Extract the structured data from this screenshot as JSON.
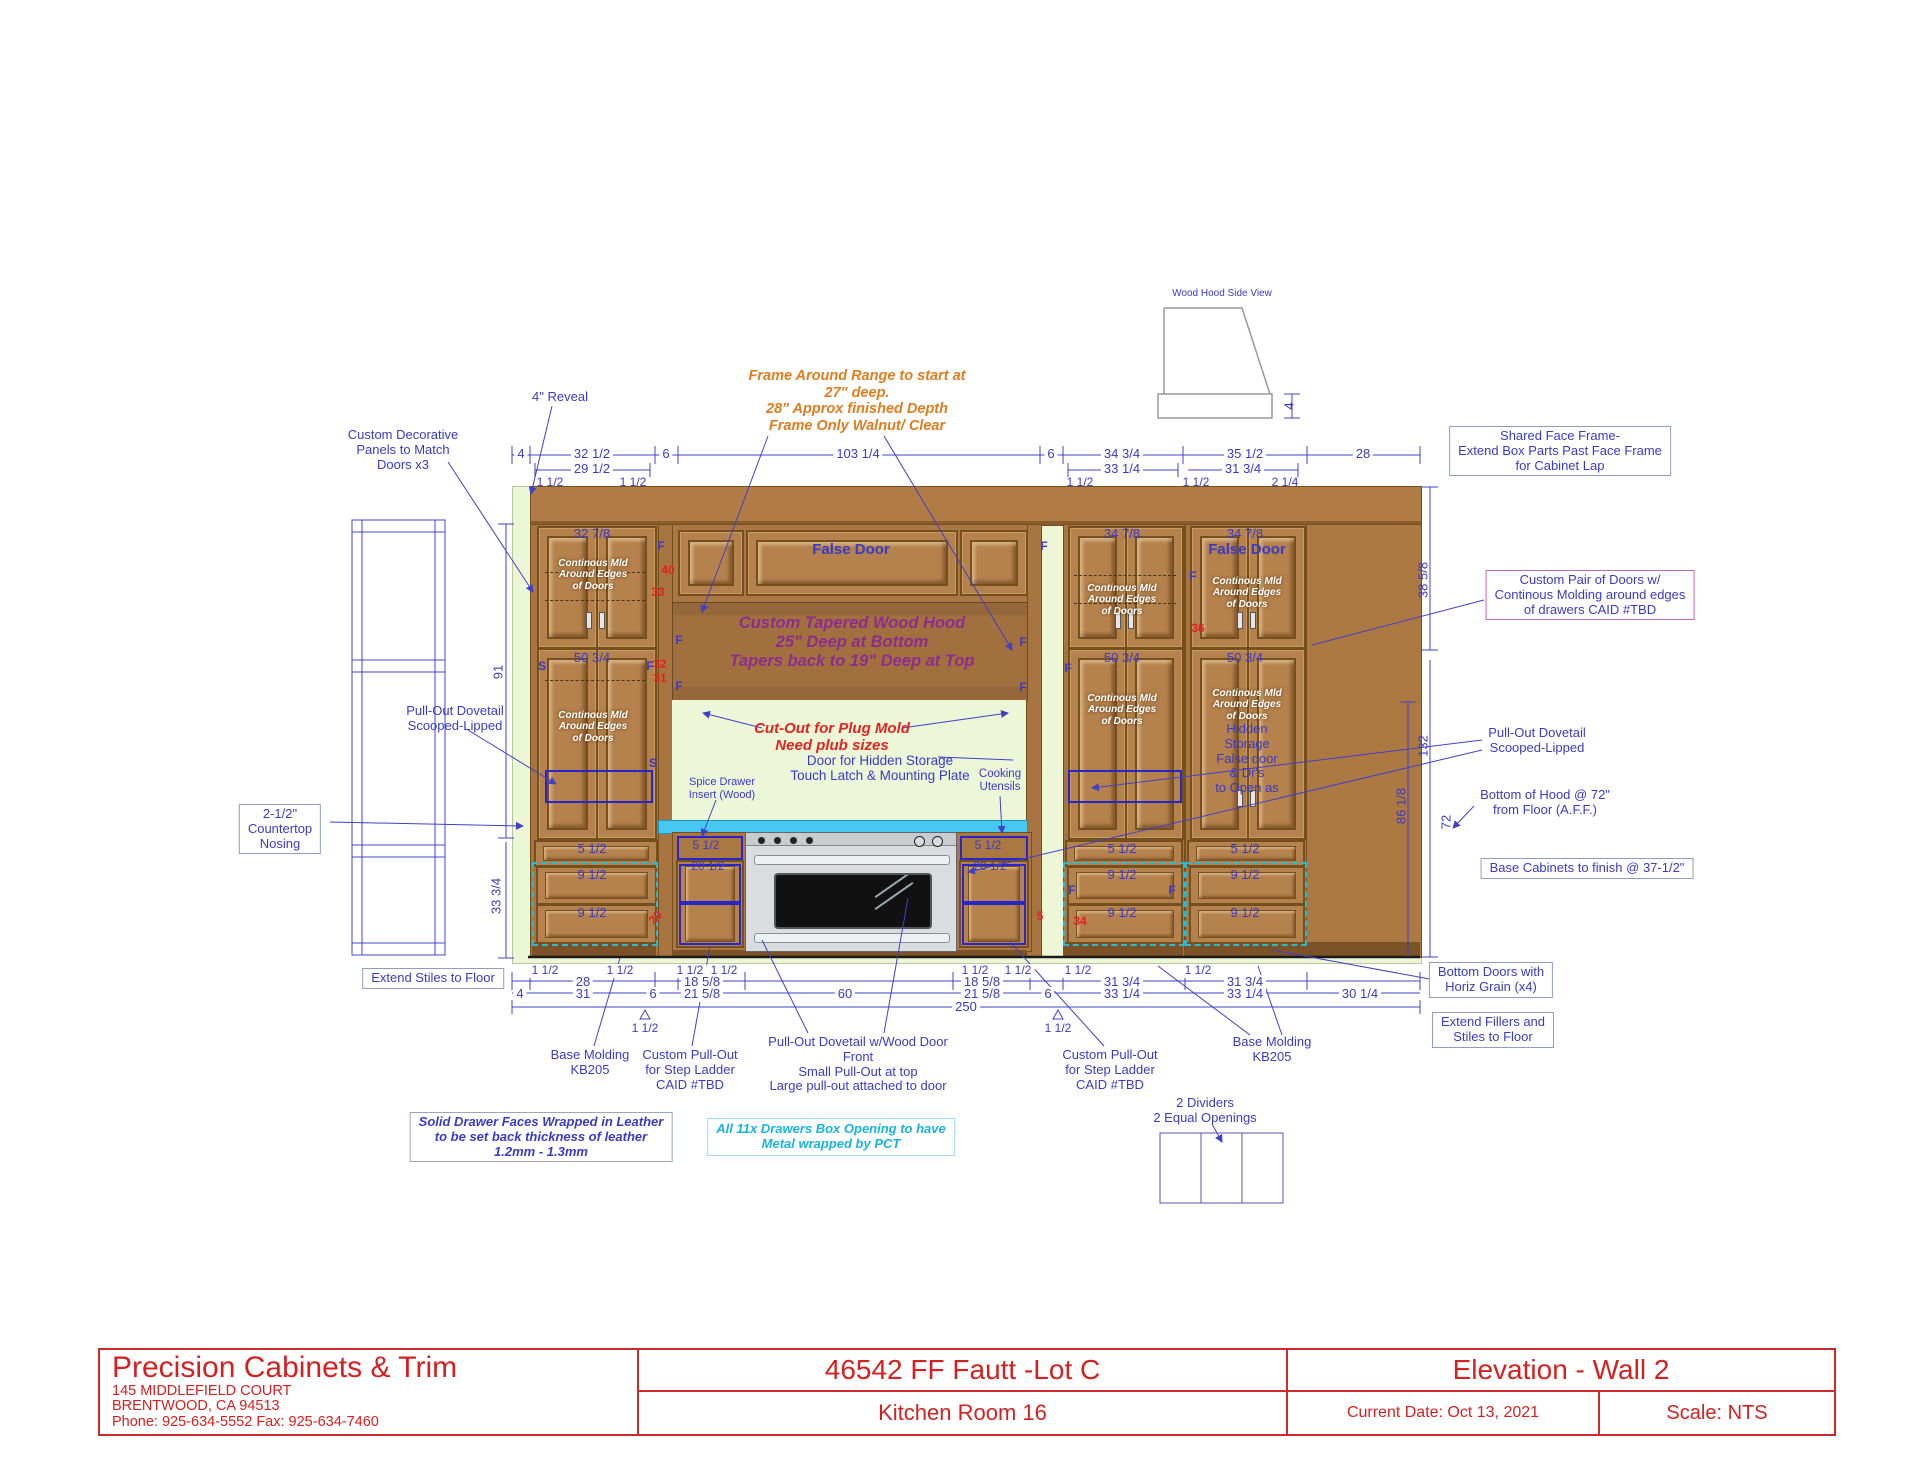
{
  "title": {
    "company": "Precision Cabinets & Trim",
    "address1": "145 MIDDLEFIELD COURT",
    "address2": "BRENTWOOD, CA 94513",
    "phone": "Phone: 925-634-5552 Fax: 925-634-7460",
    "job": "46542 FF Fautt -Lot C",
    "room": "Kitchen  Room 16",
    "view": "Elevation - Wall 2",
    "date": "Current Date: Oct 13, 2021",
    "scale": "Scale: NTS"
  },
  "labels": {
    "wood_hood_side_view": "Wood Hood Side View",
    "reveal": "4\" Reveal",
    "frame_note": "Frame Around Range to start at\n27\" deep.\n28\" Approx finished Depth\nFrame Only Walnut/ Clear",
    "custom_decorative": "Custom Decorative\nPanels to Match\nDoors x3",
    "shared_face_frame": "Shared Face Frame-\nExtend Box Parts Past Face Frame\nfor Cabinet Lap",
    "custom_pair": "Custom Pair of Doors w/\nContinous Molding around edges\nof drawers CAID #TBD",
    "pullout_dovetail": "Pull-Out Dovetail\nScooped-Lipped",
    "countertop_nosing": "2-1/2\"\nCountertop\nNosing",
    "bottom_of_hood": "Bottom of Hood @ 72\"\nfrom Floor (A.F.F.)",
    "base_finish": "Base Cabinets to finish @ 37-1/2\"",
    "extend_stiles": "Extend Stiles to Floor",
    "bottom_doors": "Bottom Doors with\nHoriz Grain (x4)",
    "extend_fillers": "Extend Fillers and\nStiles to Floor",
    "base_molding": "Base Molding\nKB205",
    "step_ladder": "Custom Pull-Out\nfor Step Ladder\nCAID #TBD",
    "dovetail_wood_door": "Pull-Out Dovetail w/Wood Door\nFront\nSmall Pull-Out at top\nLarge pull-out attached to door",
    "dividers": "2 Dividers\n2 Equal Openings",
    "leather_note": "Solid Drawer Faces Wrapped in Leather\nto be set back thickness of leather\n1.2mm - 1.3mm",
    "pct_note": "All 11x  Drawers Box Opening to have\nMetal wrapped by PCT",
    "hood_text": "Custom Tapered Wood Hood\n25\" Deep at Bottom\nTapers back to 19\" Deep at Top",
    "cutout_red": "Cut-Out for Plug Mold\nNeed plub sizes",
    "hidden_door_note": "Door for Hidden Storage\nTouch Latch & Mounting Plate",
    "spice_drawer": "Spice Drawer\nInsert (Wood)",
    "cooking_utensils": "Cooking\nUtensils",
    "false_door": "False Door",
    "continuous_mld": "Continous Mld\nAround Edges\nof Doors",
    "hidden_storage": "Hidden\nStorage\nFalse door\n& Dr's\nto Open as"
  },
  "dims": {
    "in4": "4",
    "in6": "6",
    "in28": "28",
    "in31": "31",
    "in60": "60",
    "in250": "250",
    "in1_5": "1 1/2",
    "in2_25": "2 1/4",
    "in32_5": "32 1/2",
    "in29_5": "29 1/2",
    "in103_25": "103 1/4",
    "in34_75": "34 3/4",
    "in33_25": "33 1/4",
    "in35_5": "35 1/2",
    "in31_75": "31 3/4",
    "in18_625": "18 5/8",
    "in21_625": "21 5/8",
    "in30_25": "30 1/4",
    "in91": "91",
    "in33_75": "33 3/4",
    "in38_625": "38 5/8",
    "in132": "132",
    "in86_125": "86 1/8",
    "in72": "72",
    "in32_875": "32 7/8",
    "in50_75": "50 3/4",
    "in34_875": "34 7/8",
    "in5_5": "5 1/2",
    "in9_5": "9 1/2",
    "in20_5": "20 1/2",
    "r40": "40",
    "r33": "33",
    "r32": "32",
    "r31": "31",
    "r29": "29",
    "r5": "5",
    "r36": "36",
    "r34": "34",
    "F": "F",
    "S": "S"
  },
  "colors": {
    "dim_blue": "#3a3ac8",
    "note_red": "#e32222",
    "note_orange": "#e07c1e",
    "hood_purple": "#8e2c8e",
    "title_red": "#d42020",
    "cabinet_wood": "#b5814c",
    "counter_cyan": "#47c8f2",
    "wall_green": "#eef6d8"
  }
}
